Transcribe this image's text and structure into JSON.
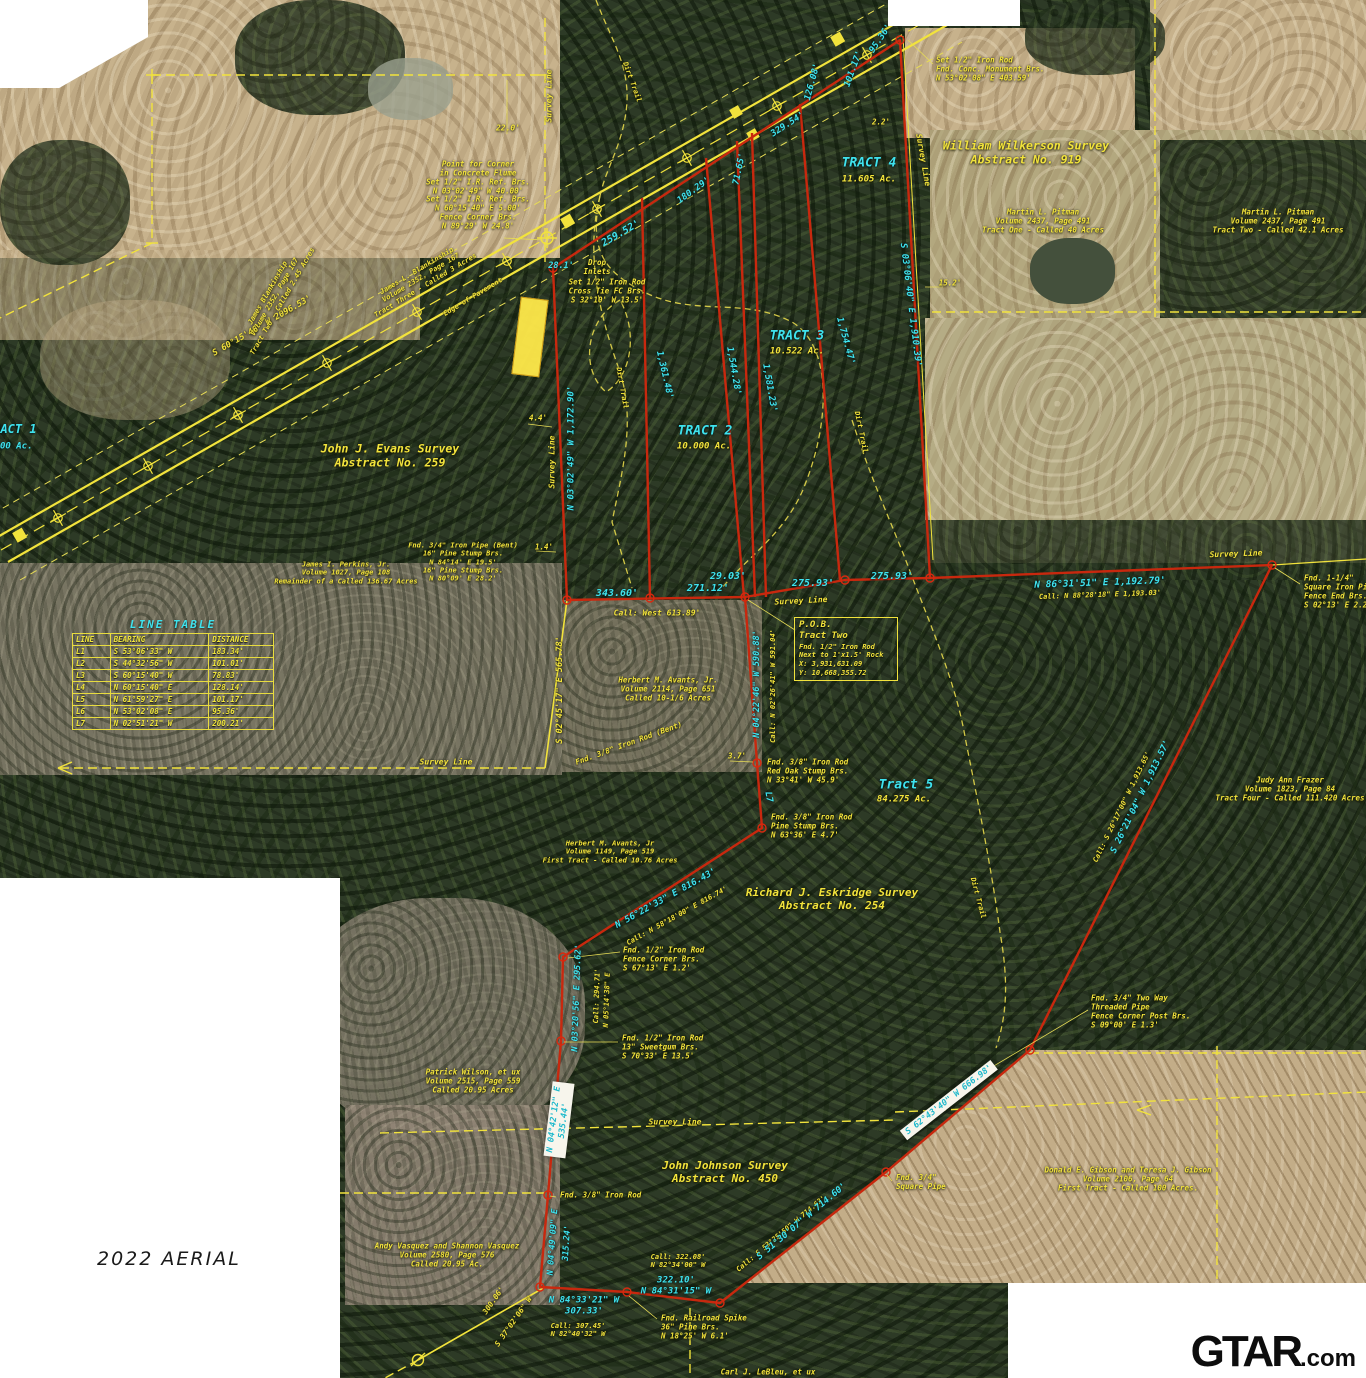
{
  "caption": {
    "text": "2022 AERIAL"
  },
  "logo": {
    "main": "GTAR",
    "suffix": ".com"
  },
  "colors": {
    "boundary_red": "#c8280e",
    "survey_yellow": "#f2e33c",
    "dim_cyan": "#3fe3ee"
  },
  "line_table": {
    "title": "LINE TABLE",
    "headers": [
      "LINE",
      "BEARING",
      "DISTANCE"
    ],
    "rows": [
      [
        "L1",
        "S 53°06'33\" W",
        "183.34'"
      ],
      [
        "L2",
        "S 44°32'56\" W",
        "101.01'"
      ],
      [
        "L3",
        "S 60°15'40\" W",
        "78.83'"
      ],
      [
        "L4",
        "N 60°15'40\" E",
        "128.14'"
      ],
      [
        "L5",
        "N 61°59'27\" E",
        "101.17'"
      ],
      [
        "L6",
        "N 53°02'08\" E",
        "95.36'"
      ],
      [
        "L7",
        "N 02°51'21\" W",
        "200.21'"
      ]
    ]
  },
  "pob_box": {
    "lines": [
      "P.O.B.",
      "Tract Two",
      "Fnd. 1/2\" Iron Rod",
      "Next to 1'x1.5' Rock",
      "X: 3,931,631.09",
      "Y: 10,668,355.72"
    ]
  },
  "labels": [
    {
      "n": "survey-line-label-top",
      "t": "Survey Line",
      "x": 549,
      "y": 96,
      "r": -90,
      "c": "y",
      "s": 8
    },
    {
      "n": "dim-22-0",
      "t": "22.0'",
      "x": 508,
      "y": 128,
      "c": "y",
      "s": 8
    },
    {
      "n": "note-point-for-corner",
      "l": [
        "Point for Corner",
        "in Concrete Flume",
        "Set 1/2\" I.R. Ref. Brs.",
        "N 03°02'49\" W 40.00'",
        "Set 1/2\" I.R. Ref. Brs.",
        "N 60°15'40\" E 5.00'",
        "Fence Corner Brs.",
        "N 89°29' W 24.8'"
      ],
      "x": 478,
      "y": 196,
      "c": "y",
      "s": 7.5
    },
    {
      "n": "note-set-iron-rod-monument",
      "l": [
        "Set 1/2\" Iron Rod",
        "Fnd. Conc. Monument Brs.",
        "N 53°02'08\" E 403.59'"
      ],
      "x": 936,
      "y": 70,
      "c": "y",
      "s": 7.5,
      "a": "l"
    },
    {
      "n": "label-wilkerson-survey",
      "l": [
        "William Wilkerson Survey",
        "Abstract No. 919"
      ],
      "x": 1026,
      "y": 153,
      "c": "y",
      "s": 11.5
    },
    {
      "n": "note-pitman-tract-one",
      "l": [
        "Martin L. Pitman",
        "Volume 2437, Page 491",
        "Tract One - Called 40 Acres"
      ],
      "x": 1043,
      "y": 222,
      "c": "y",
      "s": 7.5
    },
    {
      "n": "note-pitman-tract-two",
      "l": [
        "Martin L. Pitman",
        "Volume 2437, Page 491",
        "Tract Two - Called 42.1 Acres"
      ],
      "x": 1278,
      "y": 222,
      "c": "y",
      "s": 7.5
    },
    {
      "n": "label-tract-4",
      "t": "TRACT 4",
      "x": 869,
      "y": 163,
      "c": "c",
      "s": 13
    },
    {
      "n": "label-tract-4-acres",
      "t": "11.605 Ac.",
      "x": 869,
      "y": 180,
      "c": "y",
      "s": 9
    },
    {
      "n": "dim-95-36",
      "t": "95.36'",
      "x": 881,
      "y": 39,
      "r": -56,
      "c": "c",
      "s": 9
    },
    {
      "n": "dim-126-08",
      "t": "126.08'",
      "x": 813,
      "y": 82,
      "r": -75,
      "c": "c",
      "s": 9
    },
    {
      "n": "dim-101-17",
      "t": "101.17'",
      "x": 854,
      "y": 69,
      "r": -70,
      "c": "c",
      "s": 9
    },
    {
      "n": "dim-329-54",
      "t": "329.54'",
      "x": 788,
      "y": 125,
      "r": -33,
      "c": "c",
      "s": 9
    },
    {
      "n": "dim-71-65",
      "t": "71.65'",
      "x": 740,
      "y": 169,
      "r": -78,
      "c": "c",
      "s": 9
    },
    {
      "n": "dim-180-29",
      "t": "180.29'",
      "x": 694,
      "y": 191,
      "r": -36,
      "c": "c",
      "s": 9
    },
    {
      "n": "dim-2-2",
      "t": "2.2'",
      "x": 881,
      "y": 123,
      "c": "y",
      "s": 7.5
    },
    {
      "n": "dim-15-2",
      "t": "15.2'",
      "x": 950,
      "y": 284,
      "c": "y",
      "s": 7.5
    },
    {
      "n": "dim-highway-bearing",
      "t": "S 60°15'40\" W 2096.53'",
      "x": 262,
      "y": 326,
      "r": -30,
      "c": "y",
      "s": 8.5
    },
    {
      "n": "note-blankinship-tract-three",
      "l": [
        "James L. Blankinship",
        "Volume 2352, Page 167",
        "Tract Three - Called 3 Acres"
      ],
      "x": 421,
      "y": 278,
      "r": -31,
      "c": "y",
      "s": 7
    },
    {
      "n": "note-blankinship-tract-two",
      "l": [
        "James Blankinship",
        "Volume 2352, Page 167",
        "Tract Two - Called 2.45 Acres"
      ],
      "x": 275,
      "y": 297,
      "r": -60,
      "c": "y",
      "s": 7
    },
    {
      "n": "label-edge-of-pavement",
      "t": "Edge of Pavement",
      "x": 473,
      "y": 297,
      "r": -31,
      "c": "y",
      "s": 7
    },
    {
      "n": "dim-28-1",
      "t": "28.1'",
      "x": 561,
      "y": 266,
      "c": "c",
      "s": 8.5
    },
    {
      "n": "dim-259-52",
      "t": "259.52'",
      "x": 621,
      "y": 234,
      "r": -30,
      "c": "c",
      "s": 10
    },
    {
      "n": "note-drop-inlets",
      "l": [
        "Drop",
        "Inlets"
      ],
      "x": 597,
      "y": 268,
      "c": "y",
      "s": 7.5
    },
    {
      "n": "note-set-rod-cross-tie",
      "l": [
        "Set 1/2\" Iron Rod",
        "Cross Tie FC Brs.",
        "S 32°10' W 13.5'"
      ],
      "x": 607,
      "y": 292,
      "c": "y",
      "s": 7.5
    },
    {
      "n": "label-tract-3",
      "t": "TRACT 3",
      "x": 797,
      "y": 336,
      "c": "c",
      "s": 13
    },
    {
      "n": "label-tract-3-acres",
      "t": "10.522 Ac.",
      "x": 797,
      "y": 352,
      "c": "y",
      "s": 9
    },
    {
      "n": "label-tract-2",
      "t": "TRACT 2",
      "x": 705,
      "y": 431,
      "c": "c",
      "s": 13
    },
    {
      "n": "label-tract-2-acres",
      "t": "10.000 Ac.",
      "x": 704,
      "y": 447,
      "c": "y",
      "s": 9
    },
    {
      "n": "dim-1361-48",
      "t": "1,361.48'",
      "x": 664,
      "y": 375,
      "r": 77,
      "c": "c",
      "s": 9
    },
    {
      "n": "dim-1544-28",
      "t": "1,544.28'",
      "x": 733,
      "y": 371,
      "r": 80,
      "c": "c",
      "s": 9
    },
    {
      "n": "dim-1581-23",
      "t": "1,581.23'",
      "x": 769,
      "y": 388,
      "r": 80,
      "c": "c",
      "s": 9
    },
    {
      "n": "dim-1754-47",
      "t": "1,754.47'",
      "x": 845,
      "y": 341,
      "r": 75,
      "c": "c",
      "s": 9
    },
    {
      "n": "dim-1910-39",
      "t": "S 03°06'40\" E 1,910.39'",
      "x": 910,
      "y": 305,
      "r": 83,
      "c": "c",
      "s": 9
    },
    {
      "n": "survey-line-label-east",
      "t": "Survey Line",
      "x": 923,
      "y": 160,
      "r": 80,
      "c": "y",
      "s": 8
    },
    {
      "n": "label-dirt-trail-1",
      "t": "Dirt Trail",
      "x": 632,
      "y": 82,
      "r": 70,
      "c": "y",
      "s": 7
    },
    {
      "n": "label-dirt-trail-2",
      "t": "Dirt Trail",
      "x": 622,
      "y": 388,
      "r": 80,
      "c": "y",
      "s": 7
    },
    {
      "n": "label-dirt-trail-3",
      "t": "Dirt Trail",
      "x": 861,
      "y": 432,
      "r": 78,
      "c": "y",
      "s": 7
    },
    {
      "n": "label-dirt-trail-4",
      "t": "Dirt Trail",
      "x": 978,
      "y": 898,
      "r": 75,
      "c": "y",
      "s": 7
    },
    {
      "n": "label-evans-survey",
      "l": [
        "John J. Evans Survey",
        "Abstract No. 259"
      ],
      "x": 390,
      "y": 456,
      "c": "y",
      "s": 11.5
    },
    {
      "n": "survey-line-label-west",
      "t": "Survey Line",
      "x": 552,
      "y": 462,
      "r": -90,
      "c": "y",
      "s": 8
    },
    {
      "n": "dim-1172-90",
      "t": "N 03°02'49\" W 1,172.90'",
      "x": 572,
      "y": 448,
      "r": -90,
      "c": "c",
      "s": 9
    },
    {
      "n": "dim-4-4",
      "t": "4.4'",
      "x": 538,
      "y": 419,
      "c": "y",
      "s": 7.5
    },
    {
      "n": "dim-1-4",
      "t": "1.4'",
      "x": 544,
      "y": 548,
      "c": "y",
      "s": 7.5
    },
    {
      "n": "note-fnd-iron-pipe-bent",
      "l": [
        "Fnd. 3/4\" Iron Pipe (Bent)",
        "16\" Pine Stump Brs.",
        "N 84°14' E 19.5'",
        "16\" Pine Stump Brs.",
        "N 80°09' E 28.2'"
      ],
      "x": 463,
      "y": 562,
      "c": "y",
      "s": 7
    },
    {
      "n": "note-perkins",
      "l": [
        "James I. Perkins, Jr.",
        "Volume 1027, Page 108",
        "Remainder of a Called 136.67 Acres"
      ],
      "x": 346,
      "y": 573,
      "c": "y",
      "s": 7
    },
    {
      "n": "dim-343-60",
      "t": "343.60'",
      "x": 617,
      "y": 594,
      "c": "c",
      "s": 10
    },
    {
      "n": "dim-271-12",
      "t": "271.12'",
      "x": 708,
      "y": 589,
      "c": "c",
      "s": 10
    },
    {
      "n": "dim-29-03",
      "t": "29.03'",
      "x": 728,
      "y": 577,
      "c": "c",
      "s": 10
    },
    {
      "n": "dim-275-93-a",
      "t": "275.93'",
      "x": 813,
      "y": 584,
      "c": "c",
      "s": 10
    },
    {
      "n": "dim-275-93-b",
      "t": "275.93'",
      "x": 892,
      "y": 577,
      "c": "c",
      "s": 10
    },
    {
      "n": "note-call-west",
      "t": "Call: West 613.89'",
      "x": 657,
      "y": 613,
      "c": "y",
      "s": 8
    },
    {
      "n": "survey-line-label-pob",
      "t": "Survey Line",
      "x": 801,
      "y": 601,
      "r": -3,
      "c": "y",
      "s": 8
    },
    {
      "n": "dim-590-88",
      "t": "N 04°22'46\" W 590.88'",
      "x": 757,
      "y": 684,
      "r": -90,
      "c": "c",
      "s": 8.5
    },
    {
      "n": "note-call-591-04",
      "t": "Call: N 02°26'41\" W 591.04'",
      "x": 773,
      "y": 686,
      "r": -90,
      "c": "y",
      "s": 7
    },
    {
      "n": "note-avants-2114",
      "l": [
        "Herbert M. Avants, Jr.",
        "Volume 2114, Page 651",
        "Called 10-1/6 Acres"
      ],
      "x": 668,
      "y": 690,
      "c": "y",
      "s": 7.5
    },
    {
      "n": "dim-565-78",
      "t": "S 02°45'17\" E 565.78'",
      "x": 560,
      "y": 690,
      "r": -90,
      "c": "y",
      "s": 8.5
    },
    {
      "n": "note-fnd-38-rod-bent",
      "t": "Fnd. 3/8\" Iron Rod (Bent)",
      "x": 629,
      "y": 744,
      "r": -20,
      "c": "y",
      "s": 7.5
    },
    {
      "n": "dim-3-7",
      "t": "3.7'",
      "x": 737,
      "y": 757,
      "c": "y",
      "s": 7.5
    },
    {
      "n": "note-fnd-38-red-oak",
      "l": [
        "Fnd. 3/8\" Iron Rod",
        "Red Oak Stump Brs.",
        "N 33°41' W 45.9'"
      ],
      "x": 767,
      "y": 772,
      "c": "y",
      "s": 7.5,
      "a": "l"
    },
    {
      "n": "label-l7",
      "t": "L7",
      "x": 768,
      "y": 797,
      "r": 80,
      "c": "c",
      "s": 9
    },
    {
      "n": "note-fnd-38-pine",
      "l": [
        "Fnd. 3/8\" Iron Rod",
        "Pine Stump Brs.",
        "N 63°36' E 4.7'"
      ],
      "x": 771,
      "y": 827,
      "c": "y",
      "s": 7.5,
      "a": "l"
    },
    {
      "n": "label-tract-5",
      "t": "Tract 5",
      "x": 906,
      "y": 785,
      "c": "c",
      "s": 13
    },
    {
      "n": "label-tract-5-acres",
      "t": "84.275 Ac.",
      "x": 904,
      "y": 800,
      "c": "y",
      "s": 9
    },
    {
      "n": "label-eskridge-survey",
      "l": [
        "Richard J. Eskridge Survey",
        "Abstract No. 254"
      ],
      "x": 832,
      "y": 900,
      "c": "y",
      "s": 11
    },
    {
      "n": "note-frazer",
      "l": [
        "Judy Ann Frazer",
        "Volume 1823, Page 84",
        "Tract Four - Called 111.420 Acres"
      ],
      "x": 1290,
      "y": 790,
      "c": "y",
      "s": 7.5
    },
    {
      "n": "dim-1913-57",
      "t": "S 26°21'04\" W 1,913.57'",
      "x": 1141,
      "y": 797,
      "r": -64,
      "c": "c",
      "s": 9
    },
    {
      "n": "note-call-1913-65",
      "t": "Call: S 26°17'00\" W 1,913.65'",
      "x": 1122,
      "y": 807,
      "r": -64,
      "c": "y",
      "s": 7
    },
    {
      "n": "dim-816-43",
      "t": "N 56°22'33\" E 816.43'",
      "x": 666,
      "y": 899,
      "r": -29,
      "c": "c",
      "s": 9
    },
    {
      "n": "note-call-816-74",
      "t": "Call: N 58°18'00\" E 816.74'",
      "x": 677,
      "y": 916,
      "r": -29,
      "c": "y",
      "s": 7
    },
    {
      "n": "note-avants-1149",
      "l": [
        "Herbert M. Avants, Jr",
        "Volume 1149, Page 519",
        "First Tract - Called 10.76 Acres"
      ],
      "x": 610,
      "y": 852,
      "c": "y",
      "s": 7
    },
    {
      "n": "note-fnd-12-fence-corner",
      "l": [
        "Fnd. 1/2\" Iron Rod",
        "Fence Corner Brs.",
        "S 67°13' E 1.2'"
      ],
      "x": 623,
      "y": 960,
      "c": "y",
      "s": 7.5,
      "a": "l"
    },
    {
      "n": "dim-295-62",
      "t": "N 03°20'56\" E 295.62'",
      "x": 577,
      "y": 998,
      "r": -88,
      "c": "c",
      "s": 8.5
    },
    {
      "n": "note-call-294-71",
      "t": "Call: 294.71'",
      "x": 597,
      "y": 996,
      "r": -88,
      "c": "y",
      "s": 7
    },
    {
      "n": "note-call-n05",
      "t": "N 05°14'38\" E",
      "x": 607,
      "y": 1000,
      "r": -88,
      "c": "y",
      "s": 7
    },
    {
      "n": "note-fnd-12-sweetgum",
      "l": [
        "Fnd. 1/2\" Iron Rod",
        "13\" Sweetgum Brs.",
        "S 70°33' E 13.5'"
      ],
      "x": 622,
      "y": 1048,
      "c": "y",
      "s": 7.5,
      "a": "l"
    },
    {
      "n": "note-wilson",
      "l": [
        "Patrick Wilson, et ux",
        "Volume 2515, Page 559",
        "Called 20.95 Acres"
      ],
      "x": 473,
      "y": 1082,
      "c": "y",
      "s": 7.5
    },
    {
      "n": "survey-line-label-s1",
      "t": "Survey Line",
      "x": 675,
      "y": 1122,
      "c": "y",
      "s": 8
    },
    {
      "n": "label-johnson-survey",
      "l": [
        "John Johnson Survey",
        "Abstract No. 450"
      ],
      "x": 725,
      "y": 1173,
      "c": "y",
      "s": 11
    },
    {
      "n": "note-call-714-63",
      "t": "Call: S 53°25'50\" W 714.63'",
      "x": 781,
      "y": 1234,
      "r": -40,
      "c": "y",
      "s": 7
    },
    {
      "n": "dim-714-60",
      "t": "S 51°30'07\" W 714.60'",
      "x": 802,
      "y": 1222,
      "r": -40,
      "c": "c",
      "s": 9
    },
    {
      "n": "note-fnd-34-square-pipe",
      "l": [
        "Fnd. 3/4\"",
        "Square Pipe"
      ],
      "x": 896,
      "y": 1183,
      "c": "y",
      "s": 7.5,
      "a": "l"
    },
    {
      "n": "note-call-322-08",
      "l": [
        "Call: 322.08'",
        "N 82°34'00\" W"
      ],
      "x": 678,
      "y": 1261,
      "c": "y",
      "s": 7
    },
    {
      "n": "dim-322-10",
      "l": [
        "322.10'",
        "N 84°31'15\" W"
      ],
      "x": 676,
      "y": 1286,
      "c": "c",
      "s": 9
    },
    {
      "n": "note-fnd-38-rod-south",
      "t": "Fnd. 3/8\" Iron Rod",
      "x": 560,
      "y": 1196,
      "c": "y",
      "s": 7.5,
      "a": "l"
    },
    {
      "n": "note-vasquez",
      "l": [
        "Andy Vasquez and Shannon Vasquez",
        "Volume 2580, Page 576",
        "Called 20.95 Ac."
      ],
      "x": 447,
      "y": 1256,
      "c": "y",
      "s": 7.5
    },
    {
      "n": "dim-n04-49-09",
      "t": "N 04°49'09\" E",
      "x": 553,
      "y": 1242,
      "r": -86,
      "c": "c",
      "s": 8.5
    },
    {
      "n": "dim-315-24",
      "t": "315.24'",
      "x": 567,
      "y": 1243,
      "r": -86,
      "c": "c",
      "s": 8.5
    },
    {
      "n": "dim-307-33",
      "l": [
        "N 84°33'21\" W",
        "307.33'"
      ],
      "x": 584,
      "y": 1306,
      "c": "c",
      "s": 9
    },
    {
      "n": "note-call-307-45",
      "l": [
        "Call: 307.45'",
        "N 82°40'32\" W"
      ],
      "x": 578,
      "y": 1330,
      "c": "y",
      "s": 7
    },
    {
      "n": "dim-300-06",
      "t": "300.06'",
      "x": 494,
      "y": 1301,
      "r": -55,
      "c": "y",
      "s": 7.5
    },
    {
      "n": "dim-s37-02-06",
      "t": "S 37°02'06\" W",
      "x": 514,
      "y": 1322,
      "r": -55,
      "c": "y",
      "s": 7.5
    },
    {
      "n": "note-railroad-spike",
      "l": [
        "Fnd. Railroad Spike",
        "36\" Pine Brs.",
        "N 18°25' W 6.1'"
      ],
      "x": 661,
      "y": 1328,
      "c": "y",
      "s": 7.5,
      "a": "l"
    },
    {
      "n": "note-lebleu",
      "t": "Carl J. LeBleu, et ux",
      "x": 768,
      "y": 1373,
      "c": "y",
      "s": 7.5
    },
    {
      "n": "note-gibson",
      "l": [
        "Donald E. Gibson and Teresa J. Gibson",
        "Volume 2106, Page 64",
        "First Tract - Called 100 Acres."
      ],
      "x": 1128,
      "y": 1180,
      "c": "y",
      "s": 7.5
    },
    {
      "n": "note-fnd-two-way-pipe",
      "l": [
        "Fnd. 3/4\" Two Way",
        "Threaded Pipe",
        "Fence Corner Post Brs.",
        "S 09°00' E 1.3'"
      ],
      "x": 1091,
      "y": 1012,
      "c": "y",
      "s": 7.5,
      "a": "l"
    },
    {
      "n": "sticker-dim-535-44",
      "l": [
        "N 04°42'12\" E",
        "535.44'"
      ],
      "x": 559,
      "y": 1120,
      "r": -83,
      "c": "w",
      "s": 8.5
    },
    {
      "n": "sticker-dim-666-98",
      "t": "S 62°43'40\" W 666.98'",
      "x": 949,
      "y": 1100,
      "r": -38,
      "c": "w",
      "s": 8.5
    },
    {
      "n": "label-tract-1",
      "t": "TRACT 1",
      "x": -14,
      "y": 429,
      "c": "c",
      "s": 12,
      "a": "l"
    },
    {
      "n": "label-tract-1-acres",
      "t": "00 Ac.",
      "x": 0,
      "y": 447,
      "c": "c",
      "s": 9,
      "a": "l"
    },
    {
      "n": "note-fnd-114-square",
      "l": [
        "Fnd. 1-1/4\"",
        "Square Iron Pipe",
        "Fence End Brs.",
        "S 02°13' E 2.2'"
      ],
      "x": 1304,
      "y": 592,
      "c": "y",
      "s": 7.5,
      "a": "l"
    },
    {
      "n": "dim-1192-79",
      "t": "N 86°31'51\" E 1,192.79'",
      "x": 1100,
      "y": 583,
      "r": -2,
      "c": "c",
      "s": 9.5
    },
    {
      "n": "note-call-1193-03",
      "t": "Call: N 88°28'18\" E 1,193.03'",
      "x": 1100,
      "y": 595,
      "r": -2,
      "c": "y",
      "s": 7
    },
    {
      "n": "survey-line-label-east2",
      "t": "Survey Line",
      "x": 1236,
      "y": 554,
      "r": -2,
      "c": "y",
      "s": 8
    },
    {
      "n": "survey-line-label-s2",
      "t": "Survey Line",
      "x": 446,
      "y": 762,
      "c": "y",
      "s": 8
    }
  ]
}
